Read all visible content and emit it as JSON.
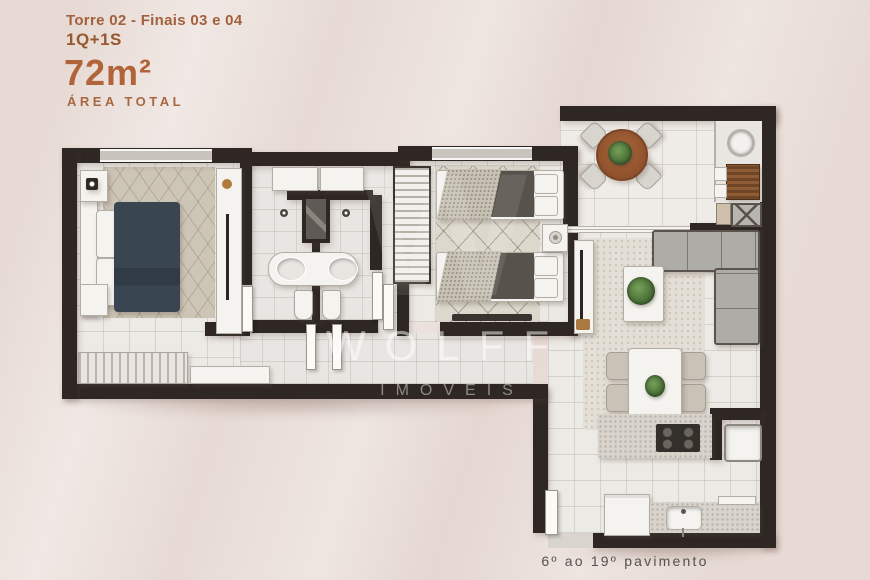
{
  "header": {
    "line1": "Torre 02 - Finais 03 e 04",
    "line2": "1Q+1S",
    "area_value": "72m²",
    "area_label": "ÁREA TOTAL"
  },
  "watermark": {
    "monogram": "W",
    "name": "WOLFF",
    "subtitle": "IMÓVEIS"
  },
  "footer": {
    "caption": "6º ao 19º pavimento"
  },
  "palette": {
    "background": "#e7dad4",
    "accent_rust": "#b1633a",
    "wall": "#2e2723",
    "floor": "#eceae5",
    "master_bed_navy": "#3a4552",
    "wood_table": "#9b5c33",
    "plant_green": "#4d7a40",
    "sofa_gray": "#aeaca7",
    "caption_gray": "#55514d",
    "watermark_white": "rgba(255,255,255,0.5)"
  }
}
